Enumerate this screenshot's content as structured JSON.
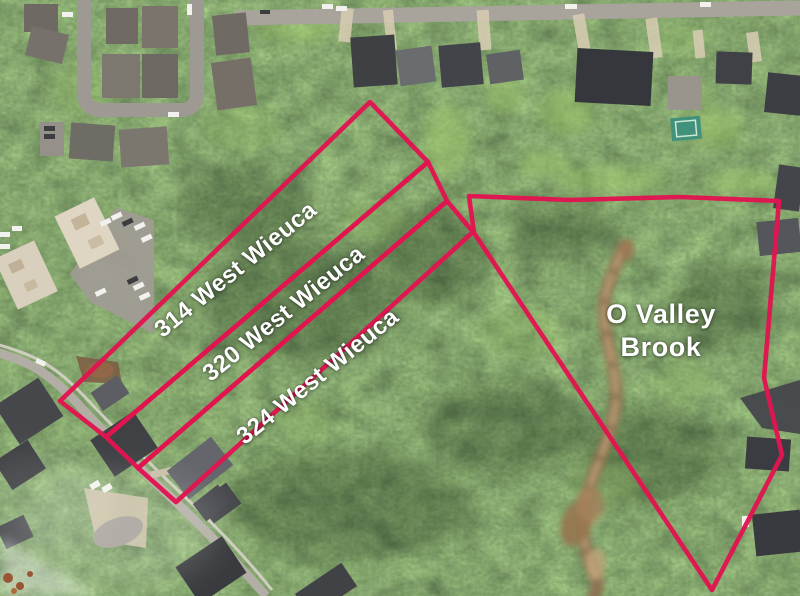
{
  "annotations": {
    "boundary_color": "#e11551",
    "label_color": "#ffffff",
    "parcels": [
      {
        "id": "314-west-wieuca",
        "label": "314 West Wieuca",
        "points": "60,401 370,102 428,162 106,437",
        "label_x": 236,
        "label_y": 270,
        "label_rotation": -39
      },
      {
        "id": "320-west-wieuca",
        "label": "320 West Wieuca",
        "points": "106,437 428,162 447,201 138,468",
        "label_x": 284,
        "label_y": 314,
        "label_rotation": -39
      },
      {
        "id": "324-west-wieuca",
        "label": "324 West Wieuca",
        "points": "138,468 447,201 473,232 176,502",
        "label_x": 318,
        "label_y": 377,
        "label_rotation": -39
      },
      {
        "id": "o-valley-brook",
        "label": "O Valley Brook",
        "label_line1": "O Valley",
        "label_line2": "Brook",
        "points": "469,196 570,200 680,197 779,201 764,378 782,455 712,590 560,362 474,233",
        "label_x": 661,
        "label_y": 331,
        "label_rotation": 0
      }
    ]
  }
}
